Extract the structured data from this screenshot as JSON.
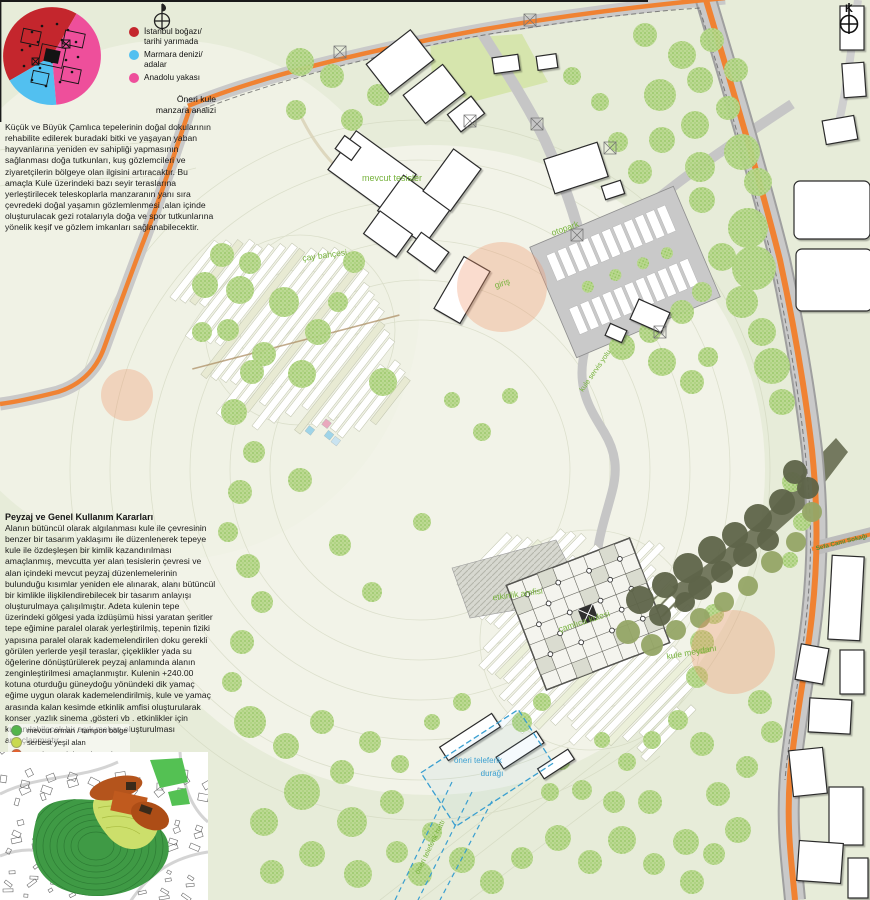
{
  "analysis": {
    "title": "Öneri kule\nmanzara analizi",
    "legend": [
      {
        "label": "İstanbul boğazı/\ntarihi yarımada",
        "color": "#c4262d"
      },
      {
        "label": "Marmara denizi/\nadalar",
        "color": "#52c0f0"
      },
      {
        "label": "Anadolu yakası",
        "color": "#ee4f9b"
      }
    ]
  },
  "paragraph1": "Küçük ve Büyük Çamlıca tepelerinin doğal dokularının rehabilite edilerek buradaki bitki ve yaşayan yaban hayvanlarına yeniden ev sahipliği yapmasının sağlanması doğa tutkunları, kuş gözlemcileri ve ziyaretçilerin bölgeye olan ilgisini artıracaktır. Bu amaçla Kule üzerindeki bazı seyir teraslarına yerleştirilecek teleskoplarla manzaranın yanı sıra çevredeki doğal yaşamın gözlemlenmesi ,alan içinde oluşturulacak gezi rotalarıyla doğa ve spor tutkunlarına yönelik keşif ve gözlem  imkanları sağlanabilecektir.",
  "section2": {
    "heading": "Peyzaj ve Genel Kullanım Kararları",
    "body": "Alanın bütüncül olarak algılanması kule ile çevresinin benzer bir tasarım yaklaşımı ile düzenlenerek tepeye kule ile özdeşleşen bir kimlik kazandırılması amaçlanmış, mevcutta yer alan tesislerin çevresi ve alan içindeki mevcut peyzaj düzenlemelerinin bulunduğu kısımlar yeniden ele alınarak, alanı bütüncül bir kimlikle ilişkilendirebilecek bir tasarım anlayışı oluşturulmaya çalışılmıştır. Adeta kulenin tepe üzerindeki gölgesi yada izdüşümü hissi yaratan şeritler tepe eğimine paralel olarak yerleştirilmiş, tepenin fiziki yapısına paralel olarak kademelendirilen doku gerekli görülen yerlerde yeşil teraslar, çiçeklikler yada su öğelerine dönüştürülerek peyzaj anlamında alanın zenginleştirilmesi amaçlanmıştır. Kulenin +240.00 kotuna oturduğu güneydoğu yönündeki dik yamaç eğime uygun olarak kademelendirilmiş, kule ve yamaç arasında kalan kesimde etkinlik amfisi oluşturularak konser ,yazlık sinema ,gösteri vb . etkinlikler için kullanılabilecek bir açık mekan oluşturulması amaçlanmıştır."
  },
  "landuse_legend": [
    {
      "label": "mevcut orman / tampon bölge",
      "color": "#53b54a"
    },
    {
      "label": "serbest yeşil alan",
      "color": "#c8d94e"
    },
    {
      "label": "öneri peyzaj düzenlemesi",
      "color": "#e8612c"
    }
  ],
  "map_labels": {
    "mevcut_tesisler": "mevcut tesisler",
    "otopark": "otopark",
    "cay_bahcesi": "çay bahçesi",
    "giris": "giriş",
    "etkinlik_amfisi": "etkinlik amfisi",
    "camlica_kulesi": "çamlıca kulesi",
    "kule_meydani": "kule meydanı",
    "kule_servis_yolu": "kule servis yolu",
    "sefa_cami_sokagi": "Sefa Cami Sokağı",
    "teleferik_duragi_line1": "öneri teleferik",
    "teleferik_duragi_line2": "durağı",
    "teleferik_hatti": "öneri teleferik hattı"
  },
  "compass": {
    "north_letter": "K"
  },
  "colors": {
    "background": "#e7ecd9",
    "road_orange": "#f08232",
    "road_gray": "#c9c9c9",
    "tree_green": "#bad88f",
    "dark_forest": "#6e7358",
    "label_green": "#76b23c",
    "teleferik_blue": "#3a9fd0",
    "entrance_peach": "#f0946a"
  }
}
